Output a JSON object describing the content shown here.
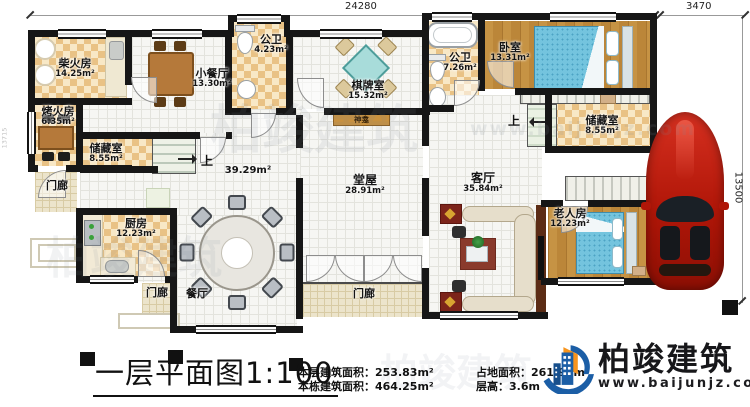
{
  "dimensions": {
    "top": "24280",
    "top_right": "3470",
    "right": "13500",
    "left": "13715"
  },
  "labels": {
    "up": "上"
  },
  "rooms": {
    "chaihuofang": {
      "name": "柴火房",
      "area": "14.25m²"
    },
    "xiaocanting": {
      "name": "小餐厅",
      "area": "13.30m²"
    },
    "gongwei_small": {
      "name": "公卫",
      "area": "4.23m²"
    },
    "qipaishi": {
      "name": "棋牌室",
      "area": "15.32m²"
    },
    "shenkan": {
      "name": "神龛"
    },
    "gongwei_big": {
      "name": "公卫",
      "area": "7.26m²"
    },
    "woshi": {
      "name": "卧室",
      "area": "13.31m²"
    },
    "kaohuofang": {
      "name": "烤火房",
      "area": "6.35m²"
    },
    "chucang_left": {
      "name": "储藏室",
      "area": "8.55m²"
    },
    "chucang_right": {
      "name": "储藏室",
      "area": "8.55m²"
    },
    "chufang": {
      "name": "厨房",
      "area": "12.23m²"
    },
    "canting": {
      "name": "餐厅"
    },
    "tangwu": {
      "name": "堂屋",
      "area": "28.91m²"
    },
    "hall": {
      "area": "39.29m²"
    },
    "keting": {
      "name": "客厅",
      "area": "35.84m²"
    },
    "laorenfang": {
      "name": "老人房",
      "area": "12.23m²"
    },
    "menlang_left": {
      "name": "门廊"
    },
    "menlang_bottom": {
      "name": "门廊"
    },
    "menlang_center": {
      "name": "门廊"
    }
  },
  "titleblock": {
    "title": "一层平面图",
    "scale": "1:100",
    "stats": [
      {
        "label": "本层建筑面积：",
        "value": "253.83m²"
      },
      {
        "label": "本栋建筑面积：",
        "value": "464.25m²"
      },
      {
        "label": "占地面积：",
        "value": "261.90m²"
      },
      {
        "label": "层高：",
        "value": "3.6m"
      }
    ],
    "brand": {
      "name": "柏竣建筑",
      "url": "www.baijunjz.com"
    }
  },
  "watermark": {
    "text": "柏竣建筑",
    "url": "www.baijunjz.com"
  }
}
